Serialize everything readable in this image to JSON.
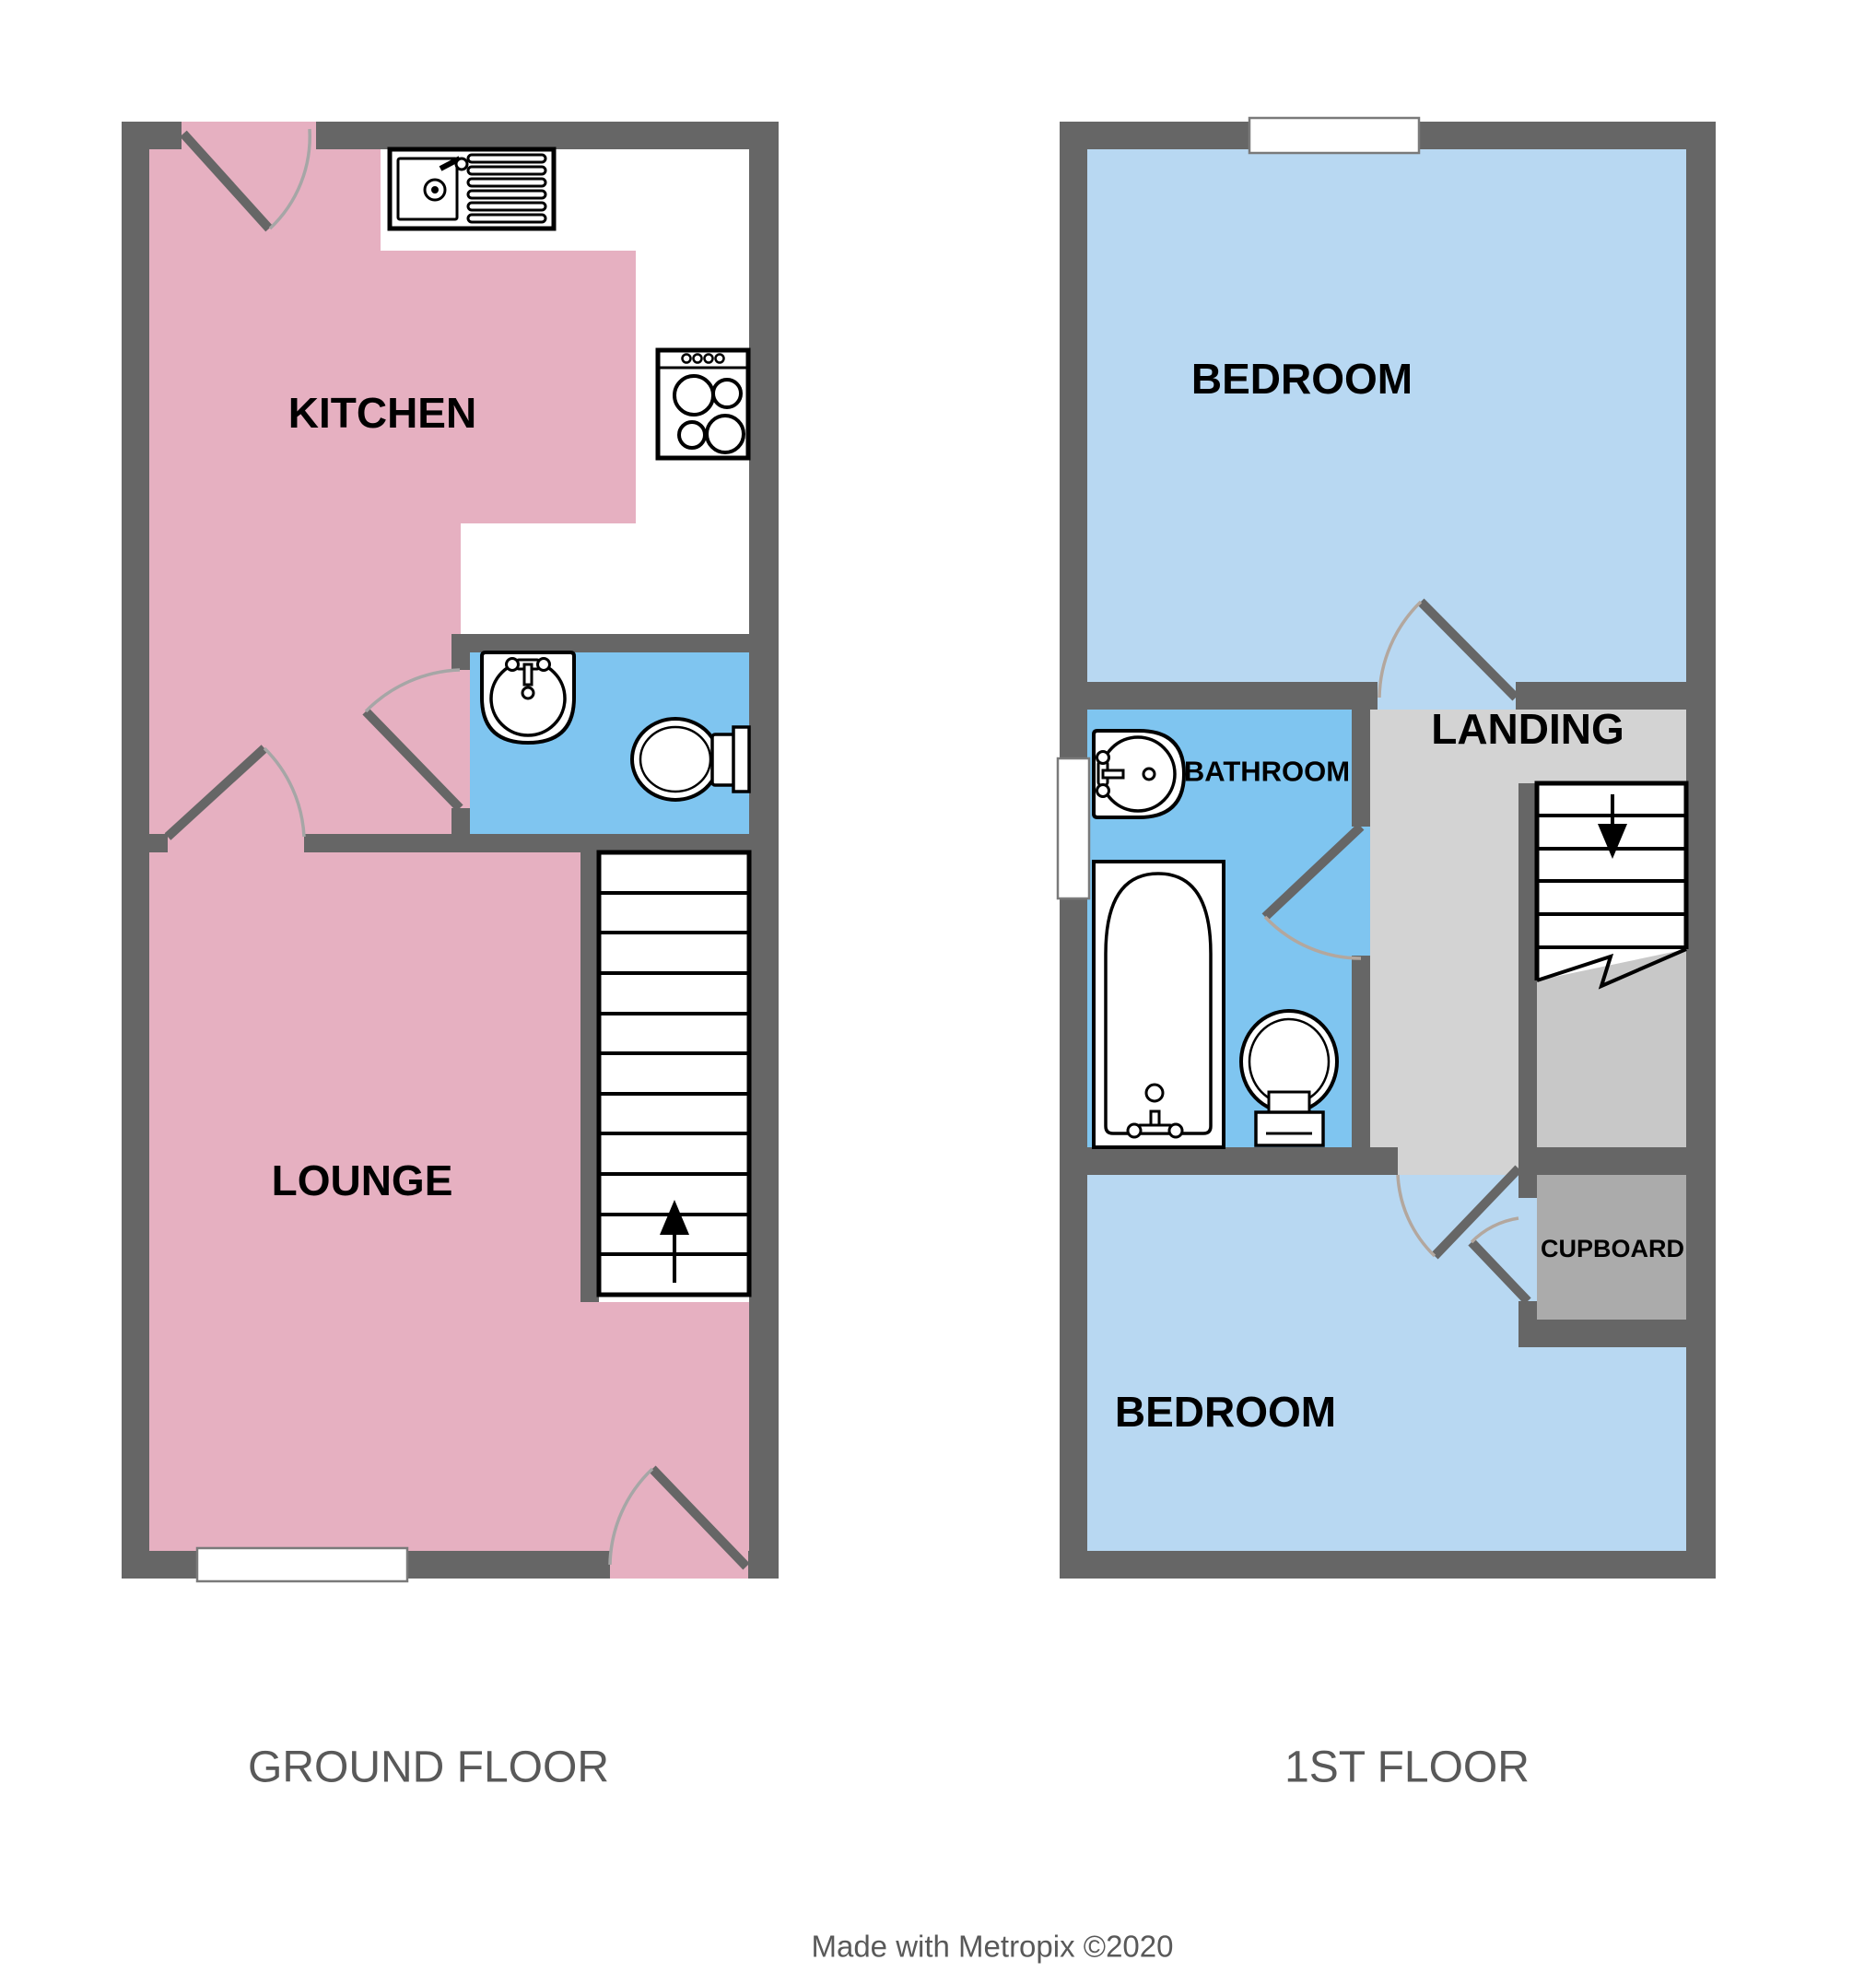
{
  "title": "Two storey house floorplan",
  "colors": {
    "wall": "#666666",
    "pink": "#E6B0C1",
    "blue": "#7FC5F0",
    "lightblue": "#B8D8F2",
    "landing": "#D3D3D3",
    "understairs": "#C8C8C8",
    "cupboard": "#ABABAB",
    "label": "#000000",
    "caption": "#595959",
    "arc": "#A6A6A6",
    "arc2": "#B3A79E"
  },
  "ground_floor": {
    "caption": "GROUND FLOOR",
    "rooms": {
      "kitchen": {
        "label": "KITCHEN"
      },
      "lounge": {
        "label": "LOUNGE"
      }
    },
    "fixtures": [
      "kitchen-sink-with-drainer",
      "cooker-hob",
      "hand-basin",
      "toilet",
      "staircase-up-arrow"
    ]
  },
  "first_floor": {
    "caption": "1ST FLOOR",
    "rooms": {
      "bedroom1": {
        "label": "BEDROOM"
      },
      "bathroom": {
        "label": "BATHROOM"
      },
      "landing": {
        "label": "LANDING"
      },
      "cupboard": {
        "label": "CUPBOARD"
      },
      "bedroom2": {
        "label": "BEDROOM"
      }
    },
    "fixtures": [
      "wash-basin",
      "bath-tub",
      "toilet",
      "staircase-down-arrow"
    ]
  },
  "footer": {
    "credit": "Made with Metropix ©2020"
  }
}
